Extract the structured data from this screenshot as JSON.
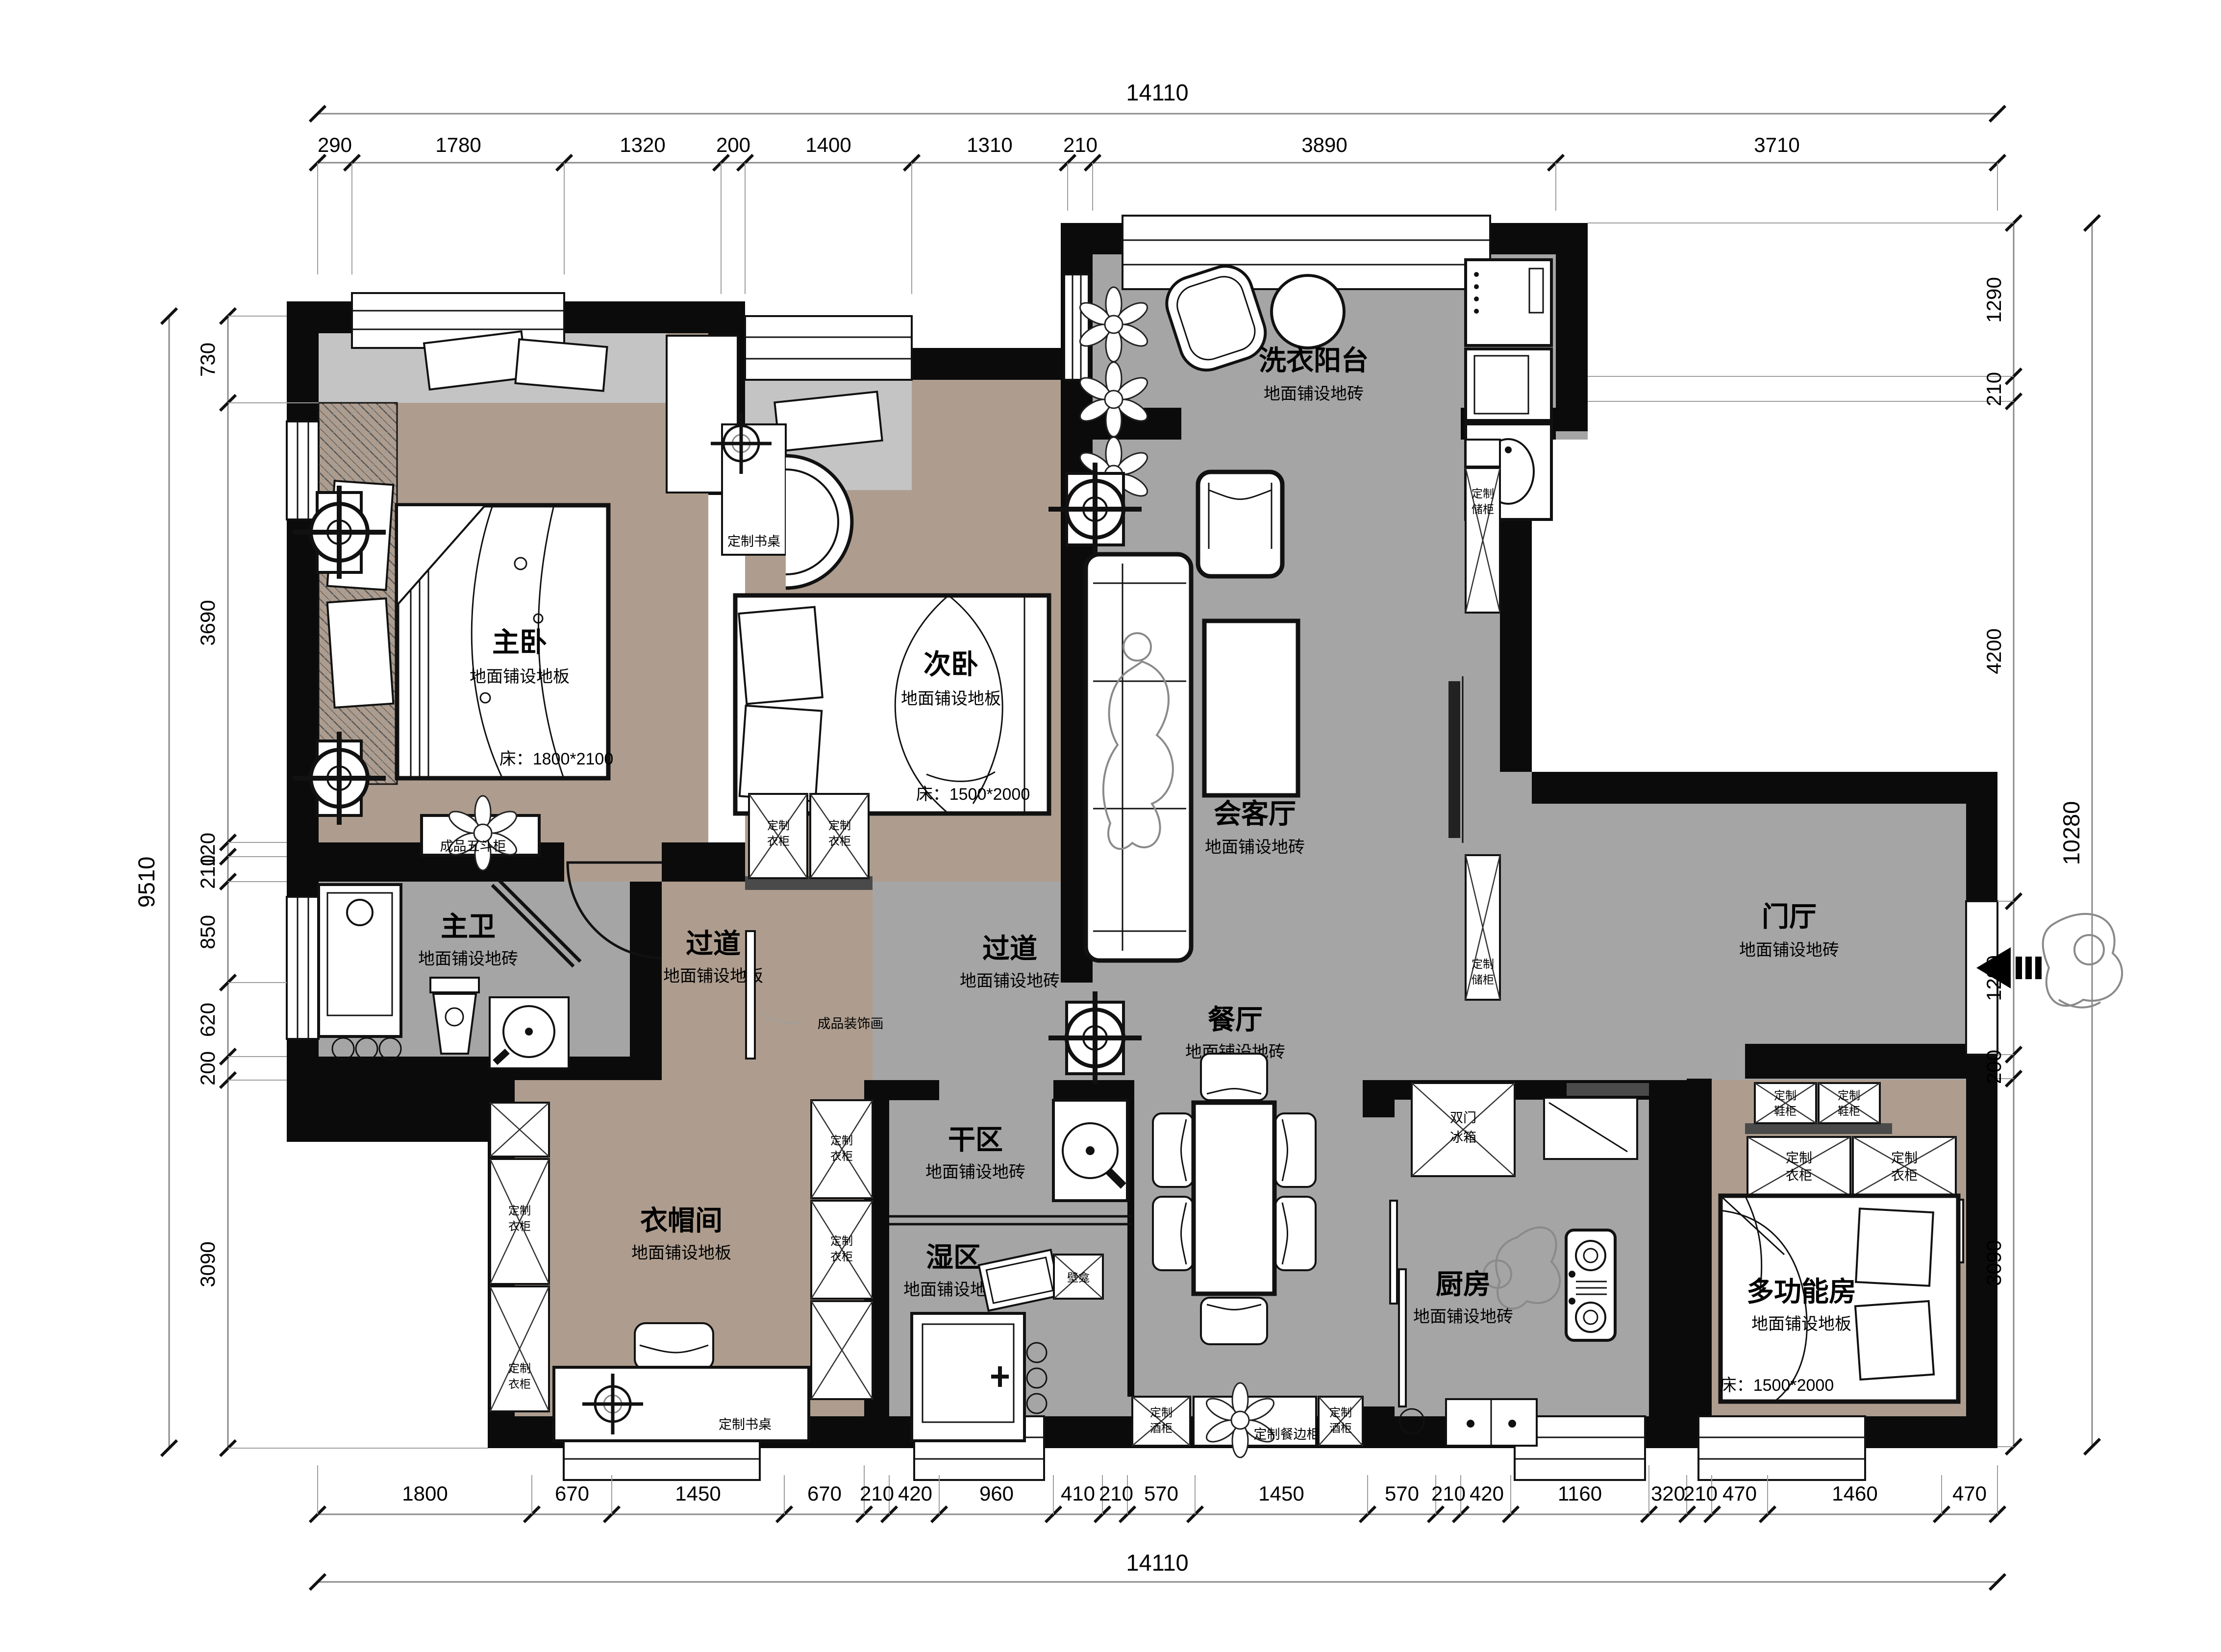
{
  "rooms": {
    "master": {
      "name": "主卧",
      "floor": "地面铺设地板",
      "bed": "床：1800*2100"
    },
    "second": {
      "name": "次卧",
      "floor": "地面铺设地板",
      "bed": "床：1500*2000"
    },
    "balcony": {
      "name": "洗衣阳台",
      "floor": "地面铺设地砖"
    },
    "living": {
      "name": "会客厅",
      "floor": "地面铺设地砖"
    },
    "bath": {
      "name": "主卫",
      "floor": "地面铺设地砖"
    },
    "hall_west": {
      "name": "过道",
      "floor": "地面铺设地板"
    },
    "hall_center": {
      "name": "过道",
      "floor": "地面铺设地砖"
    },
    "dining": {
      "name": "餐厅",
      "floor": "地面铺设地砖"
    },
    "dry": {
      "name": "干区",
      "floor": "地面铺设地砖"
    },
    "wet": {
      "name": "湿区",
      "floor": "地面铺设地砖"
    },
    "cloak": {
      "name": "衣帽间",
      "floor": "地面铺设地板"
    },
    "kitchen": {
      "name": "厨房",
      "floor": "地面铺设地砖"
    },
    "entry": {
      "name": "门厅",
      "floor": "地面铺设地砖"
    },
    "multi": {
      "name": "多功能房",
      "floor": "地面铺设地板",
      "bed": "床：1500*2000"
    }
  },
  "furniture": {
    "desk": "定制书桌",
    "wardrobe_l1": "定制",
    "wardrobe_l2": "衣柜",
    "shoe_l1": "定制",
    "shoe_l2": "鞋柜",
    "storage_l1": "定制",
    "storage_l2": "储柜",
    "wine_l1": "定制",
    "wine_l2": "酒柜",
    "sideboard": "定制餐边柜",
    "dresser": "成品五斗柜",
    "artwork": "成品装饰画",
    "fridge_l1": "双门",
    "fridge_l2": "冰箱",
    "niche": "壁龛"
  },
  "dimensions": {
    "top": {
      "total": "14110",
      "segments": [
        "290",
        "1780",
        "1320",
        "200",
        "1400",
        "1310",
        "210",
        "3890",
        "3710"
      ]
    },
    "bottom": {
      "total": "14110",
      "segments": [
        "1800",
        "670",
        "1450",
        "670",
        "210",
        "420",
        "960",
        "410",
        "210",
        "570",
        "1450",
        "570",
        "210",
        "420",
        "1160",
        "320",
        "210",
        "470",
        "1460",
        "470"
      ]
    },
    "left": {
      "total": "9510",
      "segments": [
        "730",
        "3690",
        "120",
        "210",
        "850",
        "620",
        "200",
        "3090"
      ]
    },
    "right": {
      "total": "10280",
      "segments": [
        "1290",
        "210",
        "4200",
        "1290",
        "200",
        "3090"
      ]
    }
  }
}
